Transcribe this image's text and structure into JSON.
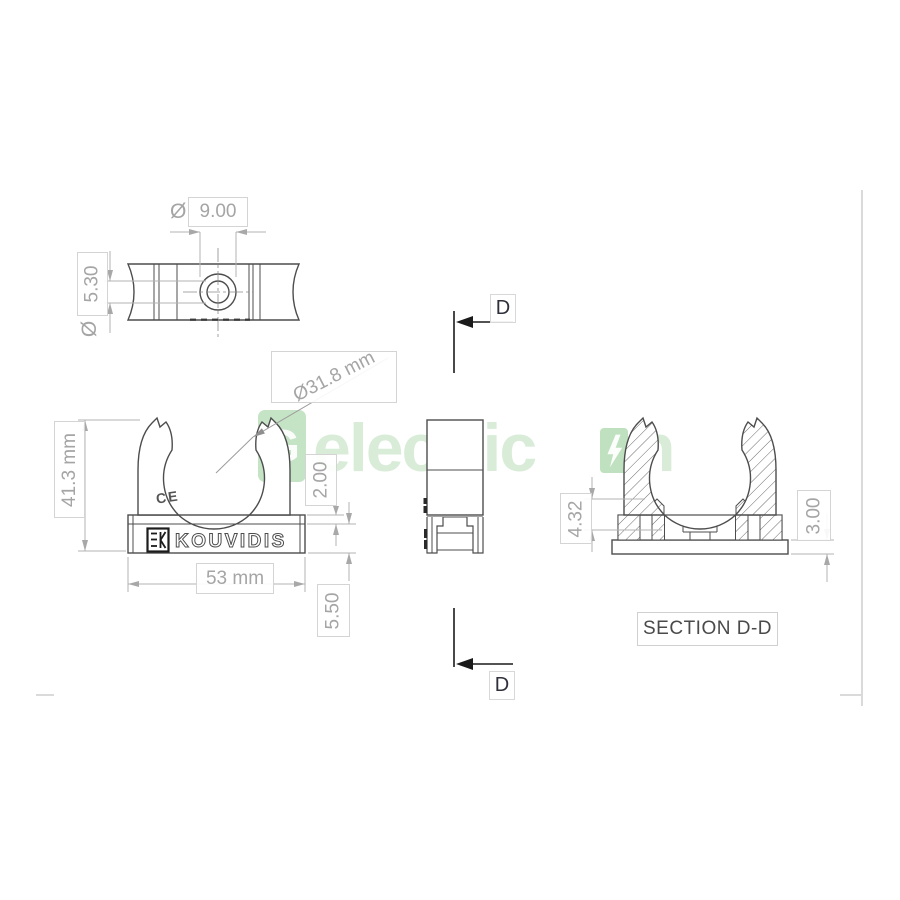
{
  "drawing": {
    "type": "technical-drawing",
    "part": "pipe clip",
    "colors": {
      "part_line": "#4d4d4d",
      "dimension_line": "#b3b3b3",
      "dimension_text": "#a5a5a5",
      "watermark_green": "#8cc98c",
      "frame_line": "#dadada"
    }
  },
  "top_view": {
    "hole_diameter_symbol": "Ø",
    "hole_diameter": "9.00",
    "pin_diameter_symbol": "Ø",
    "pin_diameter": "5.30"
  },
  "front_view": {
    "opening_diameter": "Ø31.8 mm",
    "overall_height": "41.3 mm",
    "overall_width": "53 mm",
    "lip_thickness": "2.00",
    "base_height": "5.50",
    "brand": "KOUVIDIS",
    "ce_mark": "CE",
    "logo_icon": "kouvidis-ek-monogram"
  },
  "cutting_plane": {
    "label_top": "D",
    "label_bottom": "D"
  },
  "section_view": {
    "title": "SECTION D-D",
    "rib_height": "4.32",
    "plate_thickness": "3.00"
  },
  "watermark": {
    "logo_letter": "G",
    "text_left": "electric",
    "bolt_icon": "lightning-bolt",
    "text_right": "n"
  }
}
